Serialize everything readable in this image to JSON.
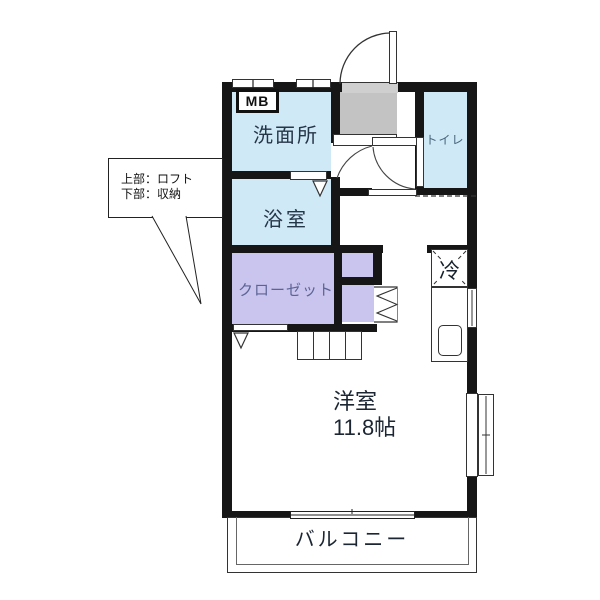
{
  "palette": {
    "wall": "#161616",
    "room-blue": "#cfe9f7",
    "room-lavender": "#c9c5ee",
    "genkan-gray": "#c3c3c3",
    "text-dark": "#1c2633",
    "text-navy": "#263649",
    "text-teal": "#48647a",
    "text-purple": "#5d6494"
  },
  "rooms": {
    "washroom": {
      "label": "洗面所"
    },
    "bathroom": {
      "label": "浴室"
    },
    "toilet": {
      "label": "トイレ"
    },
    "closet": {
      "label": "クローゼット"
    },
    "main_room": {
      "label": "洋室",
      "area": "11.8帖"
    },
    "balcony": {
      "label": "バルコニー"
    }
  },
  "annotations": {
    "meter_box": "MB",
    "refrigerator": "冷",
    "callout": {
      "line1": "上部：ロフト",
      "line2": "下部：収納"
    }
  }
}
